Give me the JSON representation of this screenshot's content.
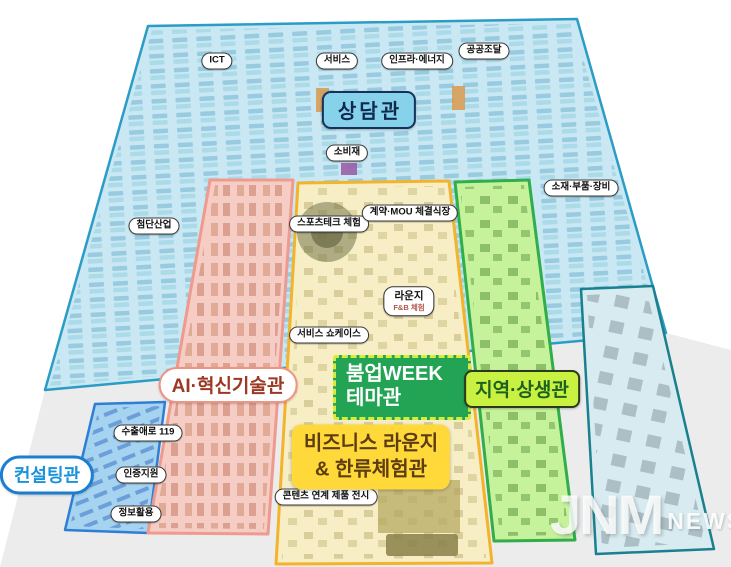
{
  "halls": {
    "counseling": {
      "label": "상담관"
    },
    "ai_innovation": {
      "label": "AI·혁신기술관"
    },
    "boomup_week": {
      "line1": "붐업WEEK",
      "line2": "테마관"
    },
    "regional": {
      "label": "지역·상생관"
    },
    "business_lounge": {
      "line1": "비즈니스 라운지",
      "line2": "& 한류체험관"
    },
    "consulting": {
      "label": "컨설팅관"
    },
    "lounge": {
      "title": "라운지",
      "subtitle": "F&B 체험"
    }
  },
  "area_pills": [
    {
      "name": "ict",
      "text": "ICT",
      "x": 217,
      "y": 61
    },
    {
      "name": "service",
      "text": "서비스",
      "x": 337,
      "y": 61
    },
    {
      "name": "infra-energy",
      "text": "인프라·에너지",
      "x": 417,
      "y": 61
    },
    {
      "name": "public-procurement",
      "text": "공공조달",
      "x": 484,
      "y": 51
    },
    {
      "name": "consumer-goods",
      "text": "소비재",
      "x": 347,
      "y": 153
    },
    {
      "name": "materials-parts-equipment",
      "text": "소재·부품·장비",
      "x": 581,
      "y": 188
    },
    {
      "name": "advanced-industry",
      "text": "첨단산업",
      "x": 154,
      "y": 226
    },
    {
      "name": "sports-tech-experience",
      "text": "스포츠테크 체험",
      "x": 329,
      "y": 224
    },
    {
      "name": "contract-mou-hall",
      "text": "계약·MOU 체결식장",
      "x": 410,
      "y": 213
    },
    {
      "name": "service-showcase",
      "text": "서비스 쇼케이스",
      "x": 329,
      "y": 335
    },
    {
      "name": "export-help-119",
      "text": "수출애로 119",
      "x": 148,
      "y": 433
    },
    {
      "name": "certification-support",
      "text": "인증지원",
      "x": 141,
      "y": 475
    },
    {
      "name": "info-utilization",
      "text": "정보활용",
      "x": 136,
      "y": 514
    },
    {
      "name": "content-linked-product-display",
      "text": "콘텐츠 연계 제품 전시",
      "x": 326,
      "y": 497
    }
  ],
  "watermark": {
    "main": "JNM",
    "sub": "NEWS"
  },
  "colors": {
    "ground": "#ececec",
    "hall_fill": "#c9e8f3",
    "hall_border": "#2a9cc5",
    "pink_fill": "#f6cdc5",
    "pink_border": "#ef9a8e",
    "yellow_fill": "#f7eec6",
    "yellow_border": "#f3b32b",
    "green_fill": "#c7f29c",
    "green_border": "#2fae4a",
    "consulting_fill": "#a5d3f0",
    "consulting_border": "#2e7fd4",
    "right_wing_fill": "#d8ebf0",
    "right_wing_border": "#18808f",
    "counseling_label_fill": "#85d2ea",
    "boomup_green": "#23a455",
    "business_yellow": "#ffd83a",
    "region_lime": "#c9f141",
    "consulting_blue": "#1a93da"
  }
}
